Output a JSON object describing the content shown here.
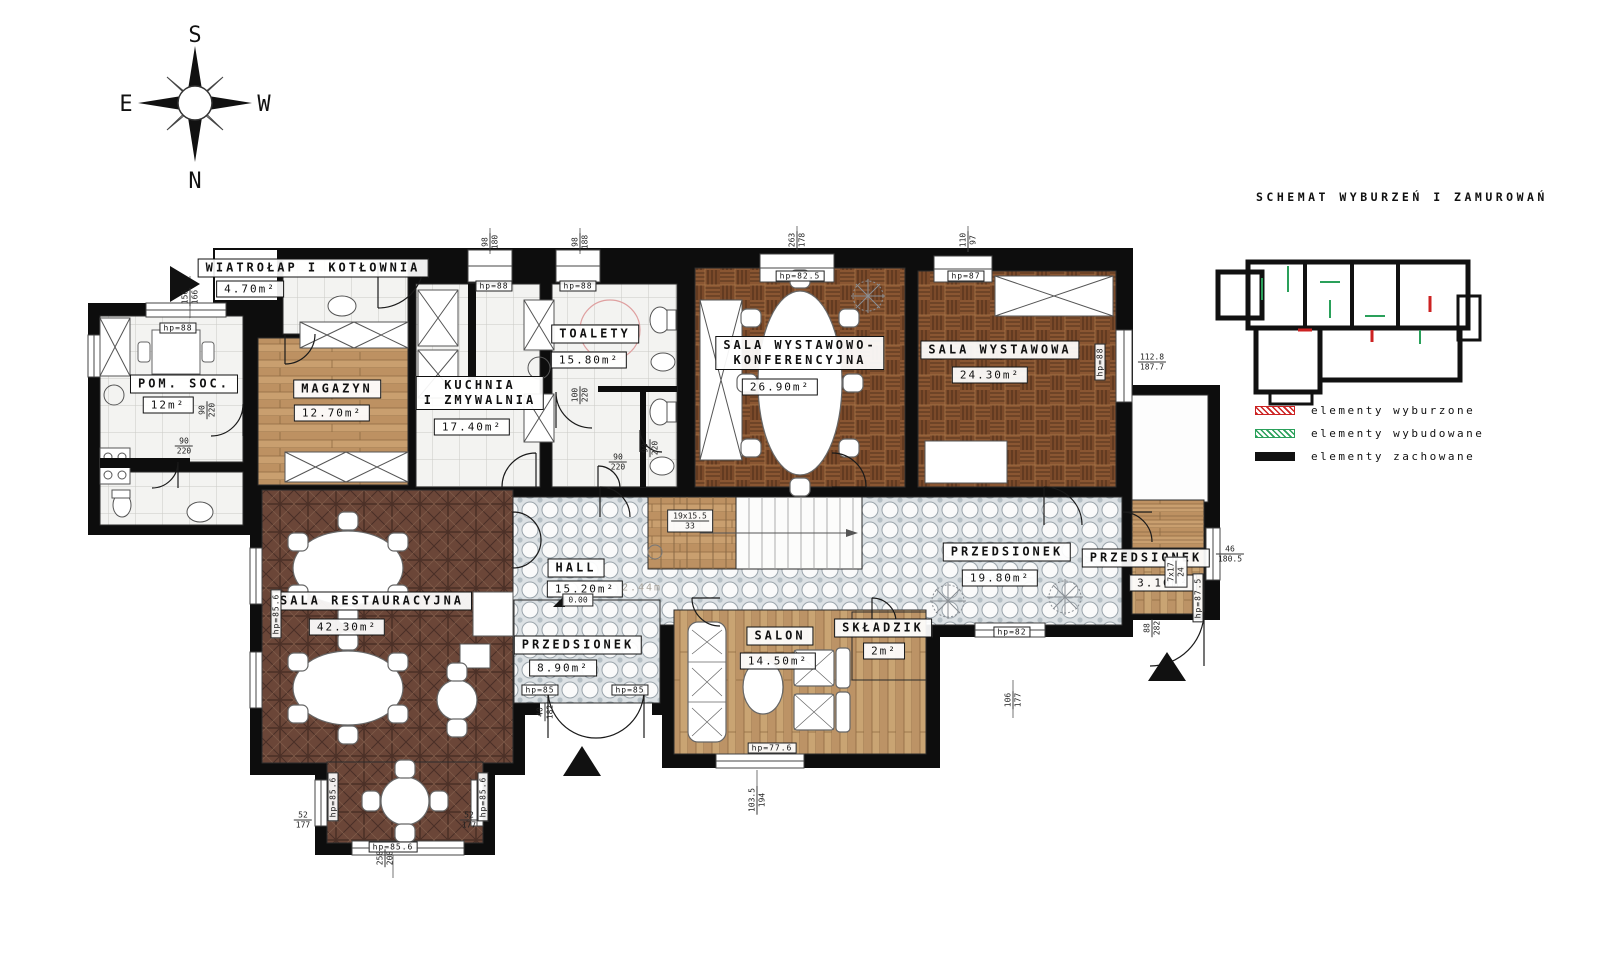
{
  "schematic": {
    "title": "SCHEMAT WYBURZEŃ I ZAMUROWAŃ"
  },
  "compass": {
    "top": "S",
    "bottom": "N",
    "left": "E",
    "right": "W"
  },
  "legend": {
    "items": [
      {
        "id": "demolished",
        "label": "elementy wyburzone",
        "color": "#cc2222"
      },
      {
        "id": "built",
        "label": "elementy wybudowane",
        "color": "#2aa05a"
      },
      {
        "id": "preserved",
        "label": "elementy zachowane",
        "color": "#111111"
      }
    ]
  },
  "rooms": [
    {
      "id": "wiatrolap-kotlownia",
      "name": [
        "WIATROŁAP I KOTŁOWNIA"
      ],
      "area": "4.70m²",
      "nx": 313,
      "ny": 268,
      "ax": 250,
      "ay": 289
    },
    {
      "id": "pom-soc",
      "name": [
        "POM. SOC."
      ],
      "area": "12m²",
      "nx": 184,
      "ny": 384,
      "ax": 168,
      "ay": 405
    },
    {
      "id": "magazyn",
      "name": [
        "MAGAZYN"
      ],
      "area": "12.70m²",
      "nx": 337,
      "ny": 389,
      "ax": 332,
      "ay": 413
    },
    {
      "id": "kuchnia-zmywalnia",
      "name": [
        "KUCHNIA",
        "I ZMYWALNIA"
      ],
      "area": "17.40m²",
      "nx": 480,
      "ny": 393,
      "ax": 472,
      "ay": 427
    },
    {
      "id": "toalety",
      "name": [
        "TOALETY"
      ],
      "area": "15.80m²",
      "nx": 595,
      "ny": 334,
      "ax": 589,
      "ay": 360
    },
    {
      "id": "sala-wyst-konf",
      "name": [
        "SALA WYSTAWOWO-",
        "KONFERENCYJNA"
      ],
      "area": "26.90m²",
      "nx": 800,
      "ny": 353,
      "ax": 780,
      "ay": 387
    },
    {
      "id": "sala-wystawowa",
      "name": [
        "SALA WYSTAWOWA"
      ],
      "area": "24.30m²",
      "nx": 1000,
      "ny": 350,
      "ax": 990,
      "ay": 375
    },
    {
      "id": "sala-restauracyjna",
      "name": [
        "SALA RESTAURACYJNA"
      ],
      "area": "42.30m²",
      "nx": 372,
      "ny": 601,
      "ax": 347,
      "ay": 627
    },
    {
      "id": "hall",
      "name": [
        "HALL"
      ],
      "area": "15.20m²",
      "nx": 576,
      "ny": 568,
      "ax": 585,
      "ay": 589
    },
    {
      "id": "przedsionek-s",
      "name": [
        "PRZEDSIONEK"
      ],
      "area": "8.90m²",
      "nx": 578,
      "ny": 645,
      "ax": 563,
      "ay": 668
    },
    {
      "id": "salon",
      "name": [
        "SALON"
      ],
      "area": "14.50m²",
      "nx": 780,
      "ny": 636,
      "ax": 778,
      "ay": 661
    },
    {
      "id": "skladzik",
      "name": [
        "SKŁADZIK"
      ],
      "area": "2m²",
      "nx": 883,
      "ny": 628,
      "ax": 884,
      "ay": 651
    },
    {
      "id": "przedsionek-e",
      "name": [
        "PRZEDSIONEK"
      ],
      "area": "19.80m²",
      "nx": 1007,
      "ny": 552,
      "ax": 1000,
      "ay": 578
    },
    {
      "id": "przedsionek-ne",
      "name": [
        "PRZEDSIONEK"
      ],
      "area": "3.10m²",
      "nx": 1146,
      "ny": 558,
      "ax": 1163,
      "ay": 583
    }
  ],
  "hp_labels": [
    {
      "t": "hp=88",
      "x": 178,
      "y": 328
    },
    {
      "t": "hp=88",
      "x": 494,
      "y": 286
    },
    {
      "t": "hp=88",
      "x": 578,
      "y": 286
    },
    {
      "t": "hp=82.5",
      "x": 800,
      "y": 276
    },
    {
      "t": "hp=87",
      "x": 966,
      "y": 276
    },
    {
      "t": "hp=88",
      "x": 1100,
      "y": 362,
      "v": 1
    },
    {
      "t": "hp=85.6",
      "x": 276,
      "y": 614,
      "v": 1
    },
    {
      "t": "hp=85.6",
      "x": 333,
      "y": 797,
      "v": 1
    },
    {
      "t": "hp=85.6",
      "x": 483,
      "y": 797,
      "v": 1
    },
    {
      "t": "hp=85.6",
      "x": 393,
      "y": 847
    },
    {
      "t": "hp=85",
      "x": 540,
      "y": 690
    },
    {
      "t": "hp=85",
      "x": 630,
      "y": 690
    },
    {
      "t": "hp=82",
      "x": 1012,
      "y": 632
    },
    {
      "t": "hp=77.6",
      "x": 772,
      "y": 748
    },
    {
      "t": "hp=87.5",
      "x": 1198,
      "y": 598,
      "v": 1
    }
  ],
  "dim_labels": [
    {
      "a": "156",
      "b": "166",
      "x": 190,
      "y": 297,
      "v": 1
    },
    {
      "a": "98",
      "b": "180",
      "x": 490,
      "y": 242,
      "v": 1
    },
    {
      "a": "98",
      "b": "188",
      "x": 580,
      "y": 242,
      "v": 1
    },
    {
      "a": "263",
      "b": "178",
      "x": 797,
      "y": 240,
      "v": 1
    },
    {
      "a": "110",
      "b": "97",
      "x": 968,
      "y": 240,
      "v": 1
    },
    {
      "a": "112.8",
      "b": "187.7",
      "x": 1152,
      "y": 362
    },
    {
      "a": "46",
      "b": "180.5",
      "x": 1230,
      "y": 554
    },
    {
      "a": "90",
      "b": "220",
      "x": 184,
      "y": 446
    },
    {
      "a": "90",
      "b": "220",
      "x": 207,
      "y": 410,
      "v": 1
    },
    {
      "a": "100",
      "b": "220",
      "x": 580,
      "y": 395,
      "v": 1
    },
    {
      "a": "90",
      "b": "220",
      "x": 650,
      "y": 448,
      "v": 1
    },
    {
      "a": "90",
      "b": "220",
      "x": 618,
      "y": 462
    },
    {
      "a": "19x15.5",
      "b": "33",
      "x": 690,
      "y": 521,
      "box": 1
    },
    {
      "a": "7x17",
      "b": "24",
      "x": 1176,
      "y": 572,
      "v": 1,
      "box": 1
    },
    {
      "a": "52",
      "b": "177",
      "x": 303,
      "y": 820
    },
    {
      "a": "52",
      "b": "177",
      "x": 469,
      "y": 820
    },
    {
      "a": "258",
      "b": "208",
      "x": 385,
      "y": 858,
      "v": 1
    },
    {
      "a": "103.5",
      "b": "194",
      "x": 757,
      "y": 800,
      "v": 1
    },
    {
      "a": "106",
      "b": "177",
      "x": 1013,
      "y": 700,
      "v": 1
    },
    {
      "a": "88",
      "b": "282",
      "x": 1152,
      "y": 628,
      "v": 1
    },
    {
      "a": "40",
      "b": "182",
      "x": 545,
      "y": 712,
      "v": 1
    },
    {
      "a": "0.00",
      "x": 578,
      "y": 600,
      "box": 1
    },
    {
      "a": "2.44m",
      "x": 642,
      "y": 588,
      "f": 1
    }
  ],
  "colors": {
    "wall": "#0d0d0d",
    "demolished": "#cc2222",
    "built": "#2aa05a",
    "wood": "#c99f6f",
    "parquet_basket": "#8a5632",
    "parquet_dark": "#6b4638"
  }
}
